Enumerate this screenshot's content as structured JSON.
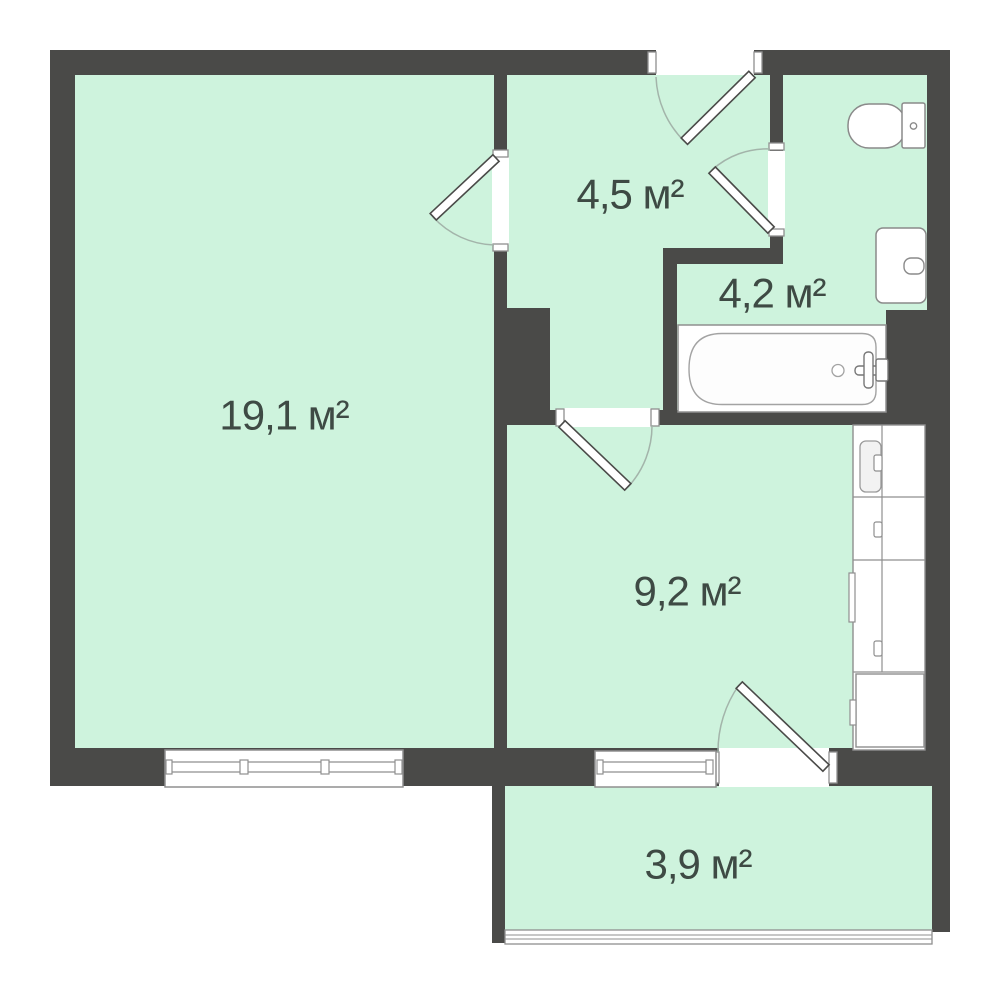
{
  "plan": {
    "type": "apartment-floor-plan",
    "rooms": [
      {
        "id": "living-room",
        "area_label": "19,1 м²"
      },
      {
        "id": "hallway",
        "area_label": "4,5 м²"
      },
      {
        "id": "bathroom",
        "area_label": "4,2 м²"
      },
      {
        "id": "kitchen",
        "area_label": "9,2 м²"
      },
      {
        "id": "balcony",
        "area_label": "3,9 м²"
      }
    ],
    "fixtures": [
      "toilet",
      "bathroom-sink",
      "bathtub",
      "bath-faucet",
      "kitchen-counter",
      "kitchen-sink"
    ],
    "openings": [
      "entrance-door",
      "living-room-door",
      "bathroom-door",
      "kitchen-door",
      "balcony-door",
      "living-room-window",
      "kitchen-window",
      "balcony-glazing"
    ],
    "colors": {
      "wall": "#4a4a48",
      "floor": "#cef3dd",
      "fixture_stroke": "#8f8f8f",
      "door_leaf_stroke": "#4a4a48",
      "swing_arc": "#a3b4aa",
      "label_text": "#3e4a44",
      "background": "#ffffff"
    }
  }
}
